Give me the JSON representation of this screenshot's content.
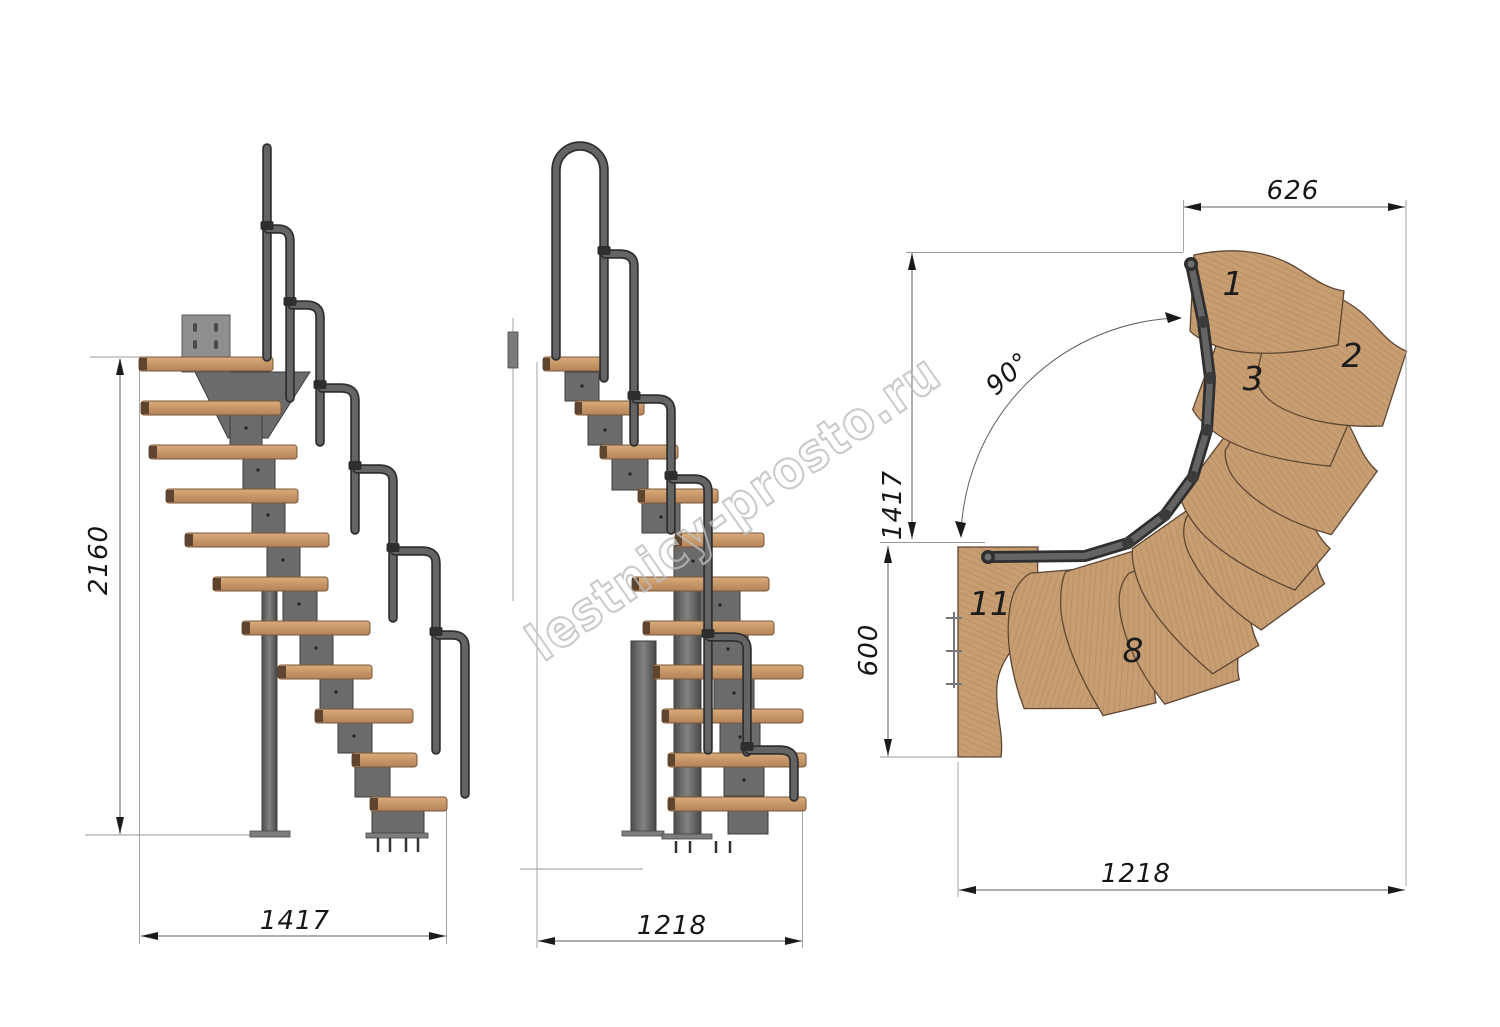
{
  "watermark": "lestnicy-prosto.ru",
  "colors": {
    "wood": "#c79d72",
    "wood_edge": "#7a5638",
    "metal": "#646464",
    "metal_dark": "#2f2f2f",
    "dimension_line": "#5f5f5f",
    "text": "#161616",
    "watermark": "#bdbdbd"
  },
  "views": {
    "side_elevation": {
      "height_mm": "2160",
      "depth_mm": "1417"
    },
    "front_elevation": {
      "depth_mm": "1218"
    },
    "plan": {
      "top_width_mm": "626",
      "flight_height_mm": "1417",
      "landing_depth_mm": "600",
      "bottom_width_mm": "1218",
      "turn_angle": "90°",
      "tread_labels": {
        "tread1": "1",
        "tread2": "2",
        "tread3": "3",
        "tread8": "8",
        "tread11": "11"
      }
    }
  }
}
